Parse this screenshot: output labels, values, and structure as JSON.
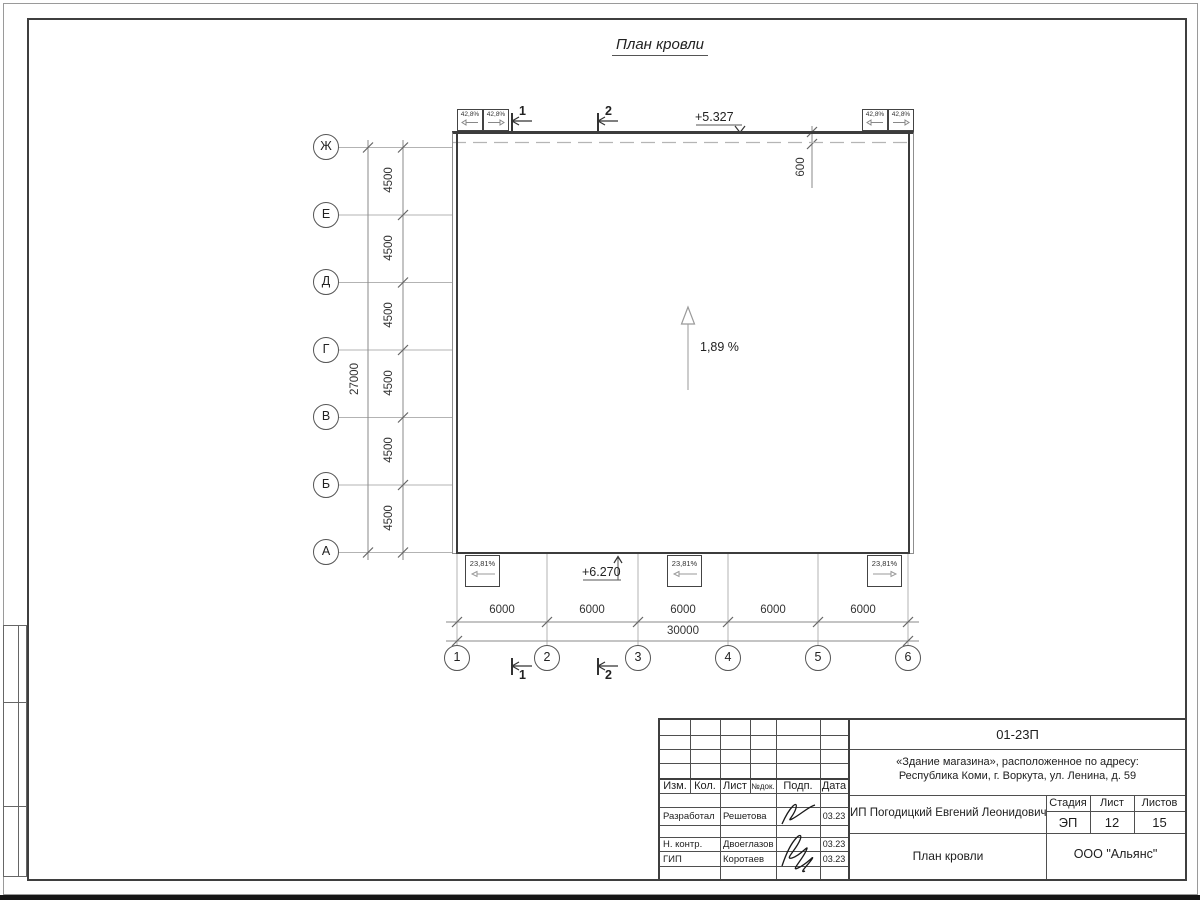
{
  "page": {
    "title": "План кровли"
  },
  "plan": {
    "row_axes": [
      "Ж",
      "Е",
      "Д",
      "Г",
      "В",
      "Б",
      "А"
    ],
    "col_axes": [
      "1",
      "2",
      "3",
      "4",
      "5",
      "6"
    ],
    "row_dims": [
      "4500",
      "4500",
      "4500",
      "4500",
      "4500",
      "4500"
    ],
    "row_total": "27000",
    "col_dims": [
      "6000",
      "6000",
      "6000",
      "6000",
      "6000"
    ],
    "col_total": "30000",
    "parapet_offset": "600",
    "elev_top": "+5.327",
    "elev_bottom": "+6.270",
    "slope": "1,89 %",
    "vent_slope_top": "42,8%",
    "vent_slope_bottom": "23,81%",
    "sections": [
      "1",
      "2"
    ]
  },
  "titleblock": {
    "doc_number": "01-23П",
    "project_line1": "«Здание магазина», расположенное по адресу:",
    "project_line2": "Республика Коми, г. Воркута, ул. Ленина, д. 59",
    "client": "ИП Погодицкий Евгений Леонидович",
    "sheet_title": "План кровли",
    "company": "ООО \"Альянс\"",
    "header_cols": [
      "Изм.",
      "Кол.",
      "Лист",
      "№док.",
      "Подп.",
      "Дата"
    ],
    "stage_label": "Стадия",
    "sheet_label": "Лист",
    "sheets_label": "Листов",
    "stage": "ЭП",
    "sheet_no": "12",
    "sheets_total": "15",
    "roles": [
      {
        "role": "Разработал",
        "name": "Решетова",
        "date": "03.23"
      },
      {
        "role": "Н. контр.",
        "name": "Двоеглазов",
        "date": "03.23"
      },
      {
        "role": "ГИП",
        "name": "Коротаев",
        "date": "03.23"
      }
    ]
  }
}
